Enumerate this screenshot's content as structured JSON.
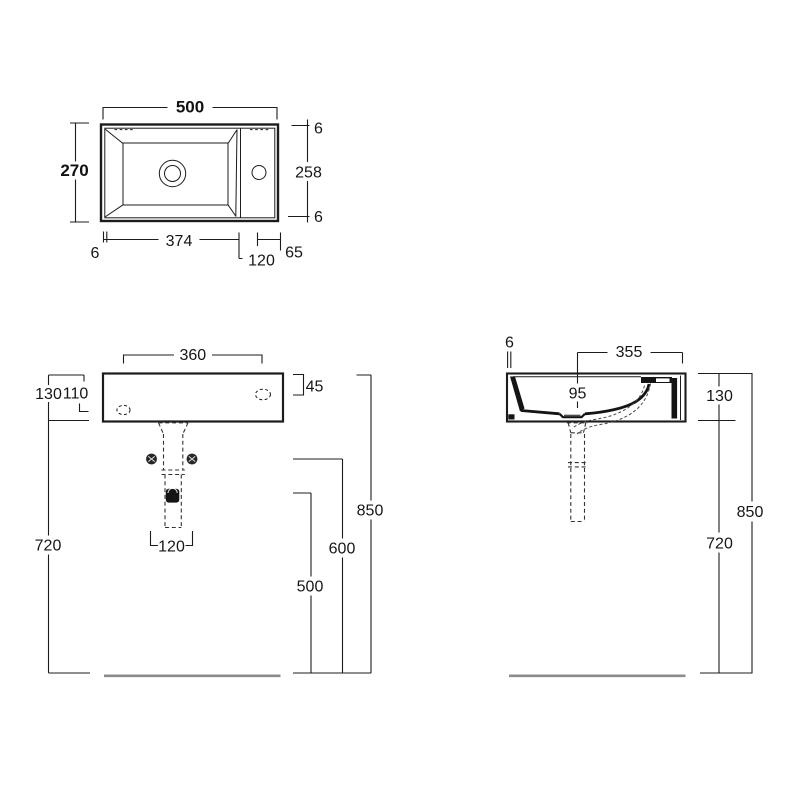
{
  "drawing": {
    "type": "washbasin-technical-drawing",
    "colors": {
      "line": "#1c1c1c",
      "section_fill": "#141414",
      "floor": "#8c8c8c",
      "background": "#ffffff"
    },
    "top_view": {
      "overall_width": "500",
      "overall_depth": "270",
      "rim_top": "6",
      "inner_depth": "258",
      "rim_bottom": "6",
      "rim_left": "6",
      "bowl_length": "374",
      "deck_width": "120",
      "tap_to_edge": "65"
    },
    "front_view": {
      "rim_width": "360",
      "basin_height": "130",
      "inner_height": "110",
      "apron_height": "45",
      "underside_height": "720",
      "rim_height": "850",
      "fixing_height": "600",
      "waste_height": "500",
      "waste_offset": "120"
    },
    "side_view": {
      "rim_lip": "6",
      "rim_depth": "355",
      "bowl_depth": "95",
      "basin_height": "130",
      "rim_height": "850",
      "underside_height": "720"
    }
  }
}
